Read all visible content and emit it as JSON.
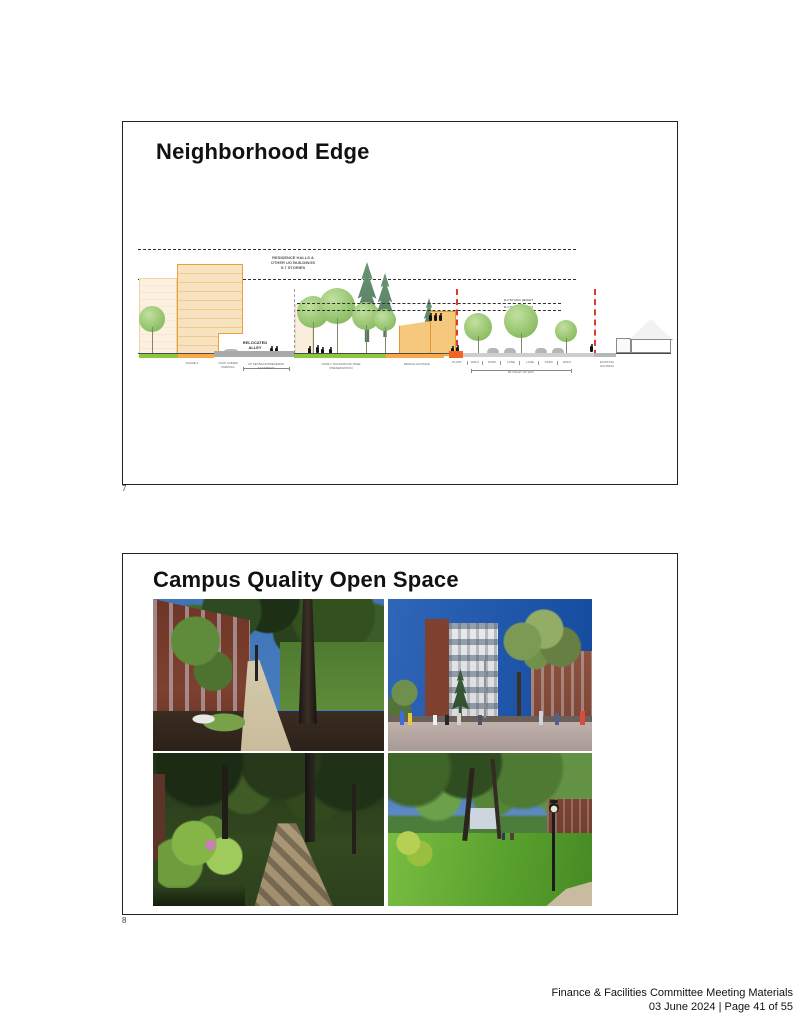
{
  "document": {
    "footer": {
      "line1": "Finance & Facilities Committee Meeting Materials",
      "line2": "03 June 2024 | Page 41 of 55"
    }
  },
  "slide1": {
    "page_number": "7",
    "title": "Neighborhood Edge",
    "diagram": {
      "labels": {
        "residence_halls": "RESIDENCE HALLS &\nOTHER UO BUILDINGS\n5-7 STORIES",
        "r2_max_height": "R-2 50' MAX HEIGHT",
        "r1_max_height": "R-1 50' MAX HEIGHT",
        "relocated_alley": "RELOCATED\nALLEY",
        "phase_2": "PHASE 2",
        "tuck_under_parking": "TUCK UNDER\nPARKING",
        "setback_easement": "20' SETBACK/PRESERVE EASEMENT",
        "tree_preservation": "FAMILY TRANSITION/ TREE PRESERVATION",
        "middle_housing": "MIDDLE HOUSING",
        "street_segments": [
          "PLANT",
          "WALK",
          "PARK",
          "LANE",
          "LANE",
          "PARK",
          "WALK"
        ],
        "right_of_way": "60' RIGHT OF WAY",
        "existing_housing": "EXISTING\nHOUSING"
      }
    }
  },
  "slide2": {
    "page_number": "8",
    "title": "Campus Quality Open Space"
  },
  "colors": {
    "building_fill": "#f8e3c0",
    "building_outline": "#e9a23b",
    "ground_green": "#8dc63f",
    "ground_orange": "#f9a84a",
    "accent_orange_red": "#f26522",
    "height_limit_red": "#e0392e",
    "road_gray": "#a7a9ac"
  }
}
